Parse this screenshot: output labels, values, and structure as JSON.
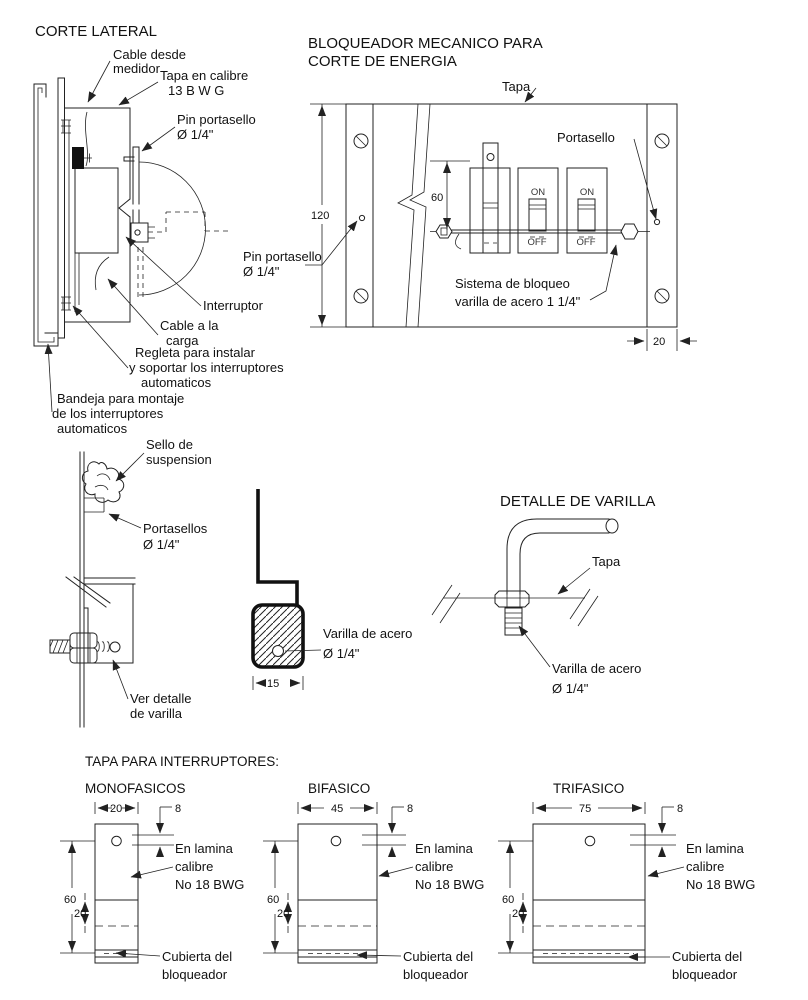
{
  "colors": {
    "line": "#222222",
    "text": "#111111",
    "background": "#ffffff"
  },
  "corte_lateral": {
    "title": "CORTE LATERAL",
    "labels": {
      "cable_desde": [
        "Cable desde",
        "medidor"
      ],
      "tapa_calibre": [
        "Tapa en calibre",
        "13 B W G"
      ],
      "pin_portasello_top": [
        "Pin portasello",
        "Ø 1/4\""
      ],
      "pin_portasello_right": [
        "Pin portasello",
        "Ø  1/4\""
      ],
      "interruptor": "Interruptor",
      "cable_carga": [
        "Cable a la",
        "carga"
      ],
      "regleta": [
        "Regleta para instalar",
        "y soportar los interruptores",
        "automaticos"
      ],
      "bandeja": [
        "Bandeja para montaje",
        "de los interruptores",
        "automaticos"
      ]
    }
  },
  "sello": {
    "labels": {
      "sello_suspension": [
        "Sello de",
        "suspension"
      ],
      "portasellos": [
        "Portasellos",
        "Ø  1/4\""
      ],
      "ver_detalle": [
        "Ver detalle",
        "de varilla"
      ]
    }
  },
  "seccion": {
    "labels": {
      "varilla_acero": [
        "Varilla  de acero",
        "Ø 1/4\""
      ]
    },
    "dims": {
      "d15": "15"
    }
  },
  "detalle_varilla": {
    "title": "DETALLE DE VARILLA",
    "labels": {
      "tapa": "Tapa",
      "varilla_acero": [
        "Varilla de acero",
        "Ø 1/4\""
      ]
    }
  },
  "bloqueador": {
    "title": [
      "BLOQUEADOR MECANICO PARA",
      "CORTE DE ENERGIA"
    ],
    "labels": {
      "tapa": "Tapa",
      "portasello": "Portasello",
      "sistema": [
        "Sistema de bloqueo",
        "varilla de acero 1 1/4\""
      ],
      "on": "ON",
      "off": "OFF"
    },
    "dims": {
      "d120": "120",
      "d60": "60",
      "d20": "20"
    }
  },
  "tapas": {
    "title": "TAPA PARA INTERRUPTORES:",
    "variants": [
      {
        "label": "MONOFASICOS",
        "width": "20"
      },
      {
        "label": "BIFASICO",
        "width": "45"
      },
      {
        "label": "TRIFASICO",
        "width": "75"
      }
    ],
    "shared": {
      "dim_8": "8",
      "dim_60": "60",
      "dim_20": "20",
      "en_lamina": [
        "En lamina",
        "calibre",
        "No 18 BWG"
      ],
      "cubierta": [
        "Cubierta del",
        "bloqueador"
      ]
    }
  }
}
